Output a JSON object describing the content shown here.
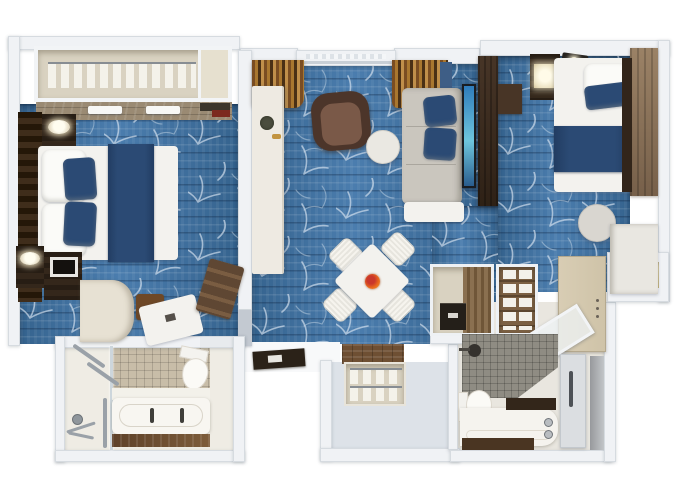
{
  "scene": {
    "type": "3d-floorplan-top-down-render",
    "description": "Two-bedroom suite floor plan: master bedroom with walk-in closet, living-dining room with balcony door, second bedroom, two bathrooms and entry vestibule, blue branch-pattern carpet"
  },
  "colors": {
    "background": "#ffffff",
    "wall": "#f0f2f5",
    "wall_edge": "#d6dbe0",
    "wall_cap": "#c3c9d1",
    "carpet_base": "#4b7dae",
    "carpet_dark": "#35638e",
    "branch_white": "#dce7f2",
    "navy": "#2b4a74",
    "linen": "#f3f2ee",
    "sofa": "#cac6be",
    "cream": "#e7e1d3",
    "closet": "#d9d2c1",
    "wood_pale": "#9a8a73",
    "wood_rich": "#6e4f33",
    "wood_dark": "#34271b",
    "chair_brown": "#4c352a",
    "chair_brown_seat": "#7a5948",
    "tile_beige": "#c8bda8",
    "tile_gray": "#8f8c83",
    "chrome": "#9aa1a8",
    "tv_screen_top": "#2f7cbb",
    "tv_screen_mid": "#6ec6de",
    "flower_orange": "#e8681e",
    "flower_red": "#c9372b",
    "door_tan": "#cfc3a8",
    "niche_cream": "#e9dcae",
    "mat_dark": "#2b2218"
  },
  "rooms": [
    {
      "name": "master-bedroom",
      "furniture": [
        "wardrobe-closet-with-hangers",
        "king-bed",
        "nightstands",
        "lamps",
        "tv-dresser",
        "vanity-desk",
        "luggage-bench",
        "headboard-wall"
      ]
    },
    {
      "name": "living-dining-room",
      "furniture": [
        "balcony-door",
        "curtains",
        "console-desk",
        "armchair",
        "round-side-table",
        "sofa-with-pillows",
        "wall-tv",
        "dining-table-for-four",
        "flower-centerpiece",
        "doormat"
      ]
    },
    {
      "name": "second-bedroom",
      "furniture": [
        "twin-bed",
        "nightstand-lamp",
        "wall-cabinet",
        "round-table",
        "dresser",
        "headboard-panel"
      ]
    },
    {
      "name": "master-bathroom",
      "furniture": [
        "shower",
        "grab-bars",
        "toilet",
        "bathtub-double-faucet",
        "wood-apron"
      ]
    },
    {
      "name": "second-bathroom",
      "furniture": [
        "mosaic-shower",
        "toilet",
        "vanity-counter",
        "door-with-handle"
      ]
    },
    {
      "name": "entry",
      "furniture": [
        "entry-door",
        "glass-door-leaf",
        "hanger-closet",
        "towel-shelves",
        "minibar-cabinet",
        "wall-niche"
      ]
    }
  ]
}
